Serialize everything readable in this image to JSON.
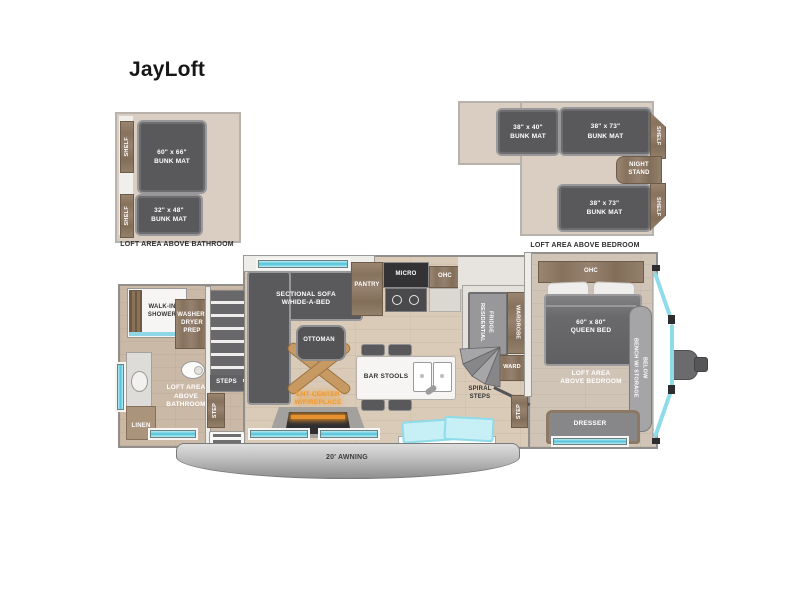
{
  "title": "JayLoft",
  "insets": {
    "bathroom_loft": {
      "caption": "LOFT AREA ABOVE BATHROOM",
      "shelf_top": "SHELF",
      "shelf_bottom": "SHELF",
      "bunk_large": "60\" x 66\"\nBUNK MAT",
      "bunk_small": "32\" x 48\"\nBUNK MAT"
    },
    "bedroom_loft": {
      "caption": "LOFT AREA ABOVE BEDROOM",
      "bunk_left": "38\" x 40\"\nBUNK MAT",
      "bunk_right": "38\" x 73\"\nBUNK MAT",
      "bunk_bottom": "38\" x 73\"\nBUNK MAT",
      "shelf_top": "SHELF",
      "shelf_bottom": "SHELF",
      "night_stand": "NIGHT\nSTAND"
    }
  },
  "floorplan": {
    "walk_in_shower": "WALK-IN\nSHOWER",
    "washer_dryer_prep": "WASHER/\nDRYER\nPREP",
    "loft_above_bathroom": "LOFT AREA\nABOVE\nBATHROOM",
    "linen": "LINEN",
    "steps": "STEPS",
    "step_left": "STEP",
    "sectional_sofa": "SECTIONAL SOFA\nW/HIDE-A-BED",
    "ottoman": "OTTOMAN",
    "ent_center": "ENT CENTER\nW/FIREPLACE",
    "pantry": "PANTRY",
    "micro": "MICRO",
    "kitchen_ohc": "OHC",
    "bar_stools": "BAR STOOLS",
    "residential_fridge": "RESIDENTIAL\nFRIDGE",
    "wardrobe": "WARDROBE",
    "ward": "WARD",
    "spiral_steps": "SPIRAL\nSTEPS",
    "step_right": "STEP",
    "bedroom_ohc": "OHC",
    "queen_bed": "60\" x 80\"\nQUEEN BED",
    "loft_above_bedroom": "LOFT AREA\nABOVE BEDROOM",
    "bench": "BENCH W/ STORAGE\nBELOW",
    "dresser": "DRESSER",
    "awning": "20' AWNING"
  },
  "colors": {
    "mat_dark": "#59595b",
    "wood": "#8a7560",
    "floor_tan": "#dacbb9",
    "window_cyan": "#4fc2da",
    "fireplace_orange": "#f49a2c"
  }
}
